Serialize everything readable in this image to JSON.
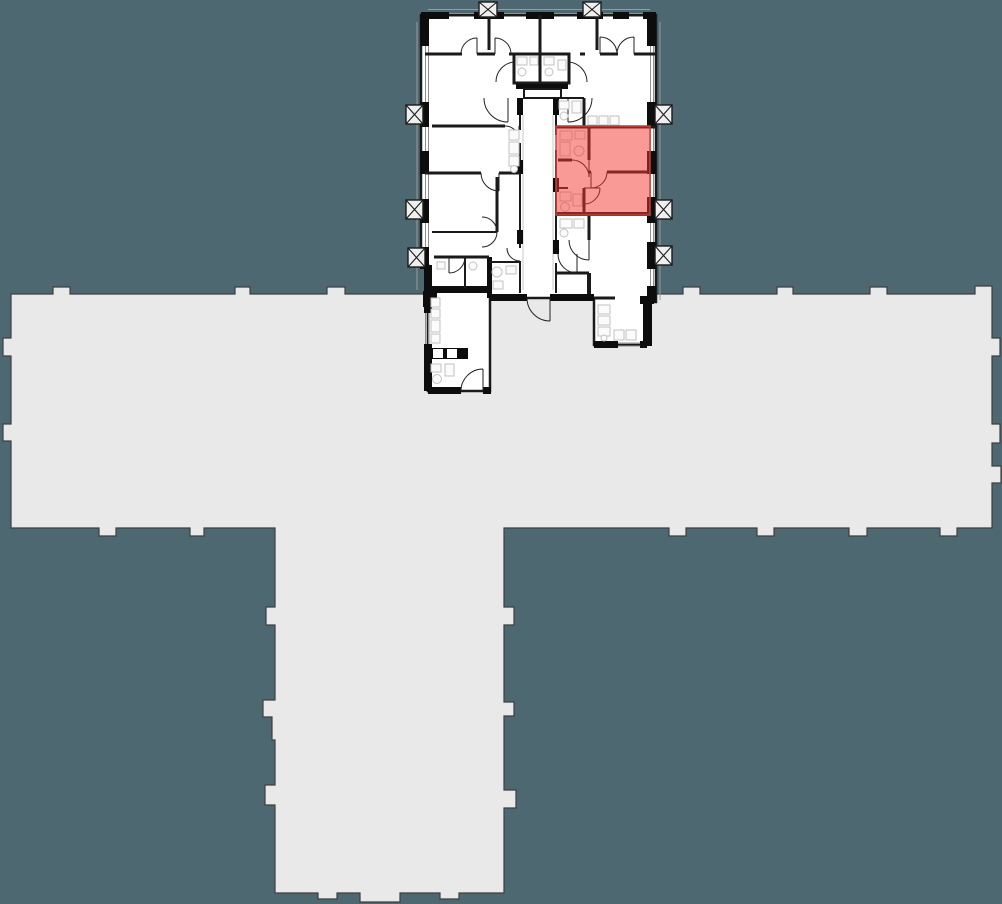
{
  "app": {
    "name": "floor-plan-viewer",
    "view": "building floor plan with one apartment highlighted"
  },
  "colors": {
    "background": "#4D6871",
    "footprint_fill": "#E9E9EA",
    "footprint_outline": "#3F3F3F",
    "plan_fill": "#FFFFFF",
    "wall": "#0D0D0D",
    "wall_soft": "#1A1A1A",
    "detail_line": "#8F8F8F",
    "facade_line": "#9B9B9B",
    "fixture_line": "#C2C2C2",
    "fixture_fill": "#FBFBFB",
    "highlight_fill": "#F5352D",
    "highlight_fill_opacity": "0.5",
    "highlight_border": "#C8443C",
    "highlight_resulting_tint": "#FA9A95",
    "shaft_fill": "#EFEFEF",
    "corridor_line": "#C9C9C9"
  },
  "building_footprint": {
    "shape": "T-shaped tower footprint with facade bumps",
    "wings": [
      "west bar",
      "east bar",
      "south stem"
    ]
  },
  "floor_plan": {
    "position": "top center, overlapping north edge of footprint bar",
    "highlighted_unit": {
      "present": true,
      "tint_hex": "#FA9A95",
      "location": "center-right of detailed plan"
    },
    "shaft_symbols_count": 8,
    "door_swing_arcs": true,
    "window_glazing_lines": true
  }
}
